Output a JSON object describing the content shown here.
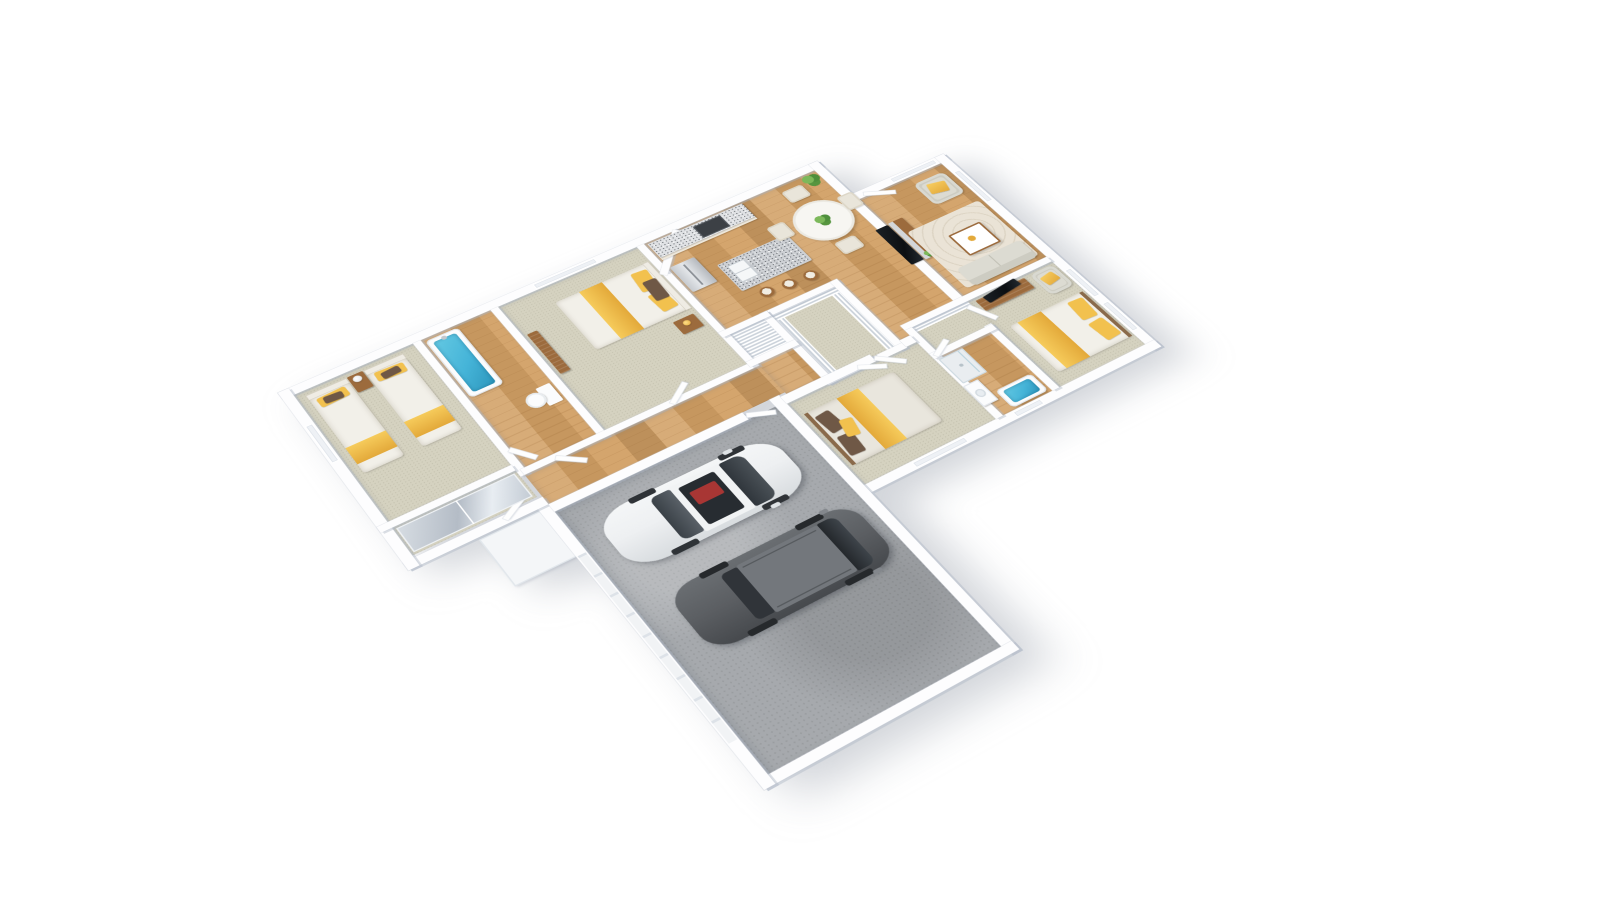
{
  "scene": {
    "type": "3d-floor-plan-render",
    "view": "rotated axonometric dollhouse view, white background",
    "description": "3D floor plan of a single-story house with three bedrooms plus master suite, two and a half bathrooms, open kitchen and dining area, living room, utility room, hallway and a two-car garage containing a white coupe and a gray SUV"
  },
  "palette": {
    "wall": "#fdfdfe",
    "wood": "#d2a065",
    "carpet": "#d5d2c0",
    "concrete": "#a6a9ad",
    "accent": "#f2c14e",
    "accent-deep": "#e3a93a",
    "tub": "#45b4d8",
    "granite": "#cdd0d4",
    "upholstery": "#cdccc2",
    "upholstery-light": "#dcdbd2",
    "wood-furniture": "#9c6b3d",
    "plant": "#56953f",
    "car-white": "#eef0f2",
    "car-gray": "#5b5e62",
    "duvet": "#f2f0e9",
    "pillow-brown": "#6f5846",
    "steel": "#c3c7cc"
  },
  "rooms": [
    {
      "id": "bedroom-twin",
      "label": "Bedroom with two twin beds, yellow bedding, shared nightstand with lamp, mirrored sliding closet",
      "floor": "carpet"
    },
    {
      "id": "hall-bathroom",
      "label": "Hall bathroom with blue-filled bathtub and toilet",
      "floor": "wood"
    },
    {
      "id": "bedroom-2",
      "label": "Bedroom with double bed, yellow throw, headboard shelf, nightstand and dresser",
      "floor": "carpet"
    },
    {
      "id": "kitchen",
      "label": "Kitchen with corner pantry, stainless refrigerator, cooktop counter and granite island with sink and three bar stools",
      "floor": "wood"
    },
    {
      "id": "dining",
      "label": "Dining area with round white table, four chairs and potted plant",
      "floor": "wood"
    },
    {
      "id": "living-room",
      "label": "Living room with recessed wall TV, media console with plant, armchair, patterned rug, coffee table and sofa",
      "floor": "wood"
    },
    {
      "id": "master-bedroom",
      "label": "Master bedroom with double bed, dresser with TV and armchair",
      "floor": "carpet"
    },
    {
      "id": "master-bathroom",
      "label": "Master bathroom with walk-in shower, vanity sink and blue-filled bathtub",
      "floor": "wood"
    },
    {
      "id": "walk-in-closet",
      "label": "Walk-in closet with shelving",
      "floor": "carpet"
    },
    {
      "id": "utility-room",
      "label": "Utility / storage room lined with shelving",
      "floor": "carpet"
    },
    {
      "id": "linen-closet",
      "label": "Linen closet with shelves",
      "floor": "shelves"
    },
    {
      "id": "bedroom-4",
      "label": "Bedroom with double bed, yellow throw and brown pillows",
      "floor": "carpet"
    },
    {
      "id": "hallway",
      "label": "Wood-floored hallway with white interior doors",
      "floor": "wood"
    },
    {
      "id": "entry",
      "label": "Entry door beside living room",
      "floor": "wood"
    },
    {
      "id": "porch",
      "label": "Side entry porch slab",
      "floor": "white"
    },
    {
      "id": "garage",
      "label": "Two-car garage with concrete floor",
      "floor": "concrete"
    }
  ],
  "vehicles": [
    {
      "id": "white-coupe",
      "label": "White coupe with dark glass, sunroof and red interior"
    },
    {
      "id": "gray-suv",
      "label": "Dark gray SUV wagon"
    }
  ],
  "fixtures": {
    "bathtubs": 2,
    "toilets": 1,
    "showers": 1,
    "beds": 5,
    "bar_stools": 3,
    "dining_chairs": 4,
    "armchairs": 2,
    "sofas": 1,
    "tvs": 2,
    "plants": 3
  }
}
